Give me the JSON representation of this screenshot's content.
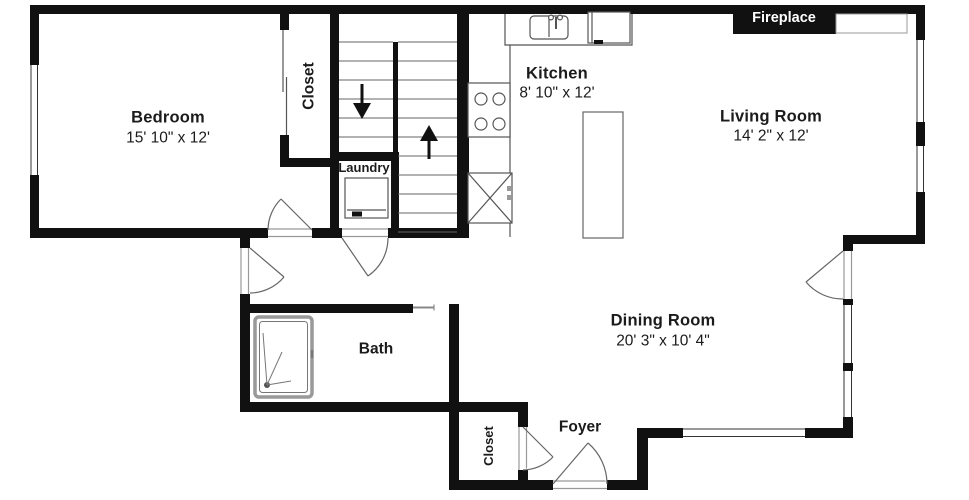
{
  "plan": {
    "title": "First floor apartment floor plan",
    "rooms": {
      "bedroom": {
        "name": "Bedroom",
        "dimensions": "15' 10\" x 12'"
      },
      "kitchen": {
        "name": "Kitchen",
        "dimensions": "8' 10\" x 12'"
      },
      "living_room": {
        "name": "Living Room",
        "dimensions": "14' 2\" x 12'"
      },
      "dining_room": {
        "name": "Dining Room",
        "dimensions": "20' 3\" x 10' 4\""
      },
      "bath": {
        "name": "Bath"
      },
      "laundry": {
        "name": "Laundry"
      },
      "foyer": {
        "name": "Foyer"
      },
      "bedroom_closet": {
        "name": "Closet"
      },
      "foyer_closet": {
        "name": "Closet"
      },
      "fireplace": {
        "name": "Fireplace"
      }
    },
    "fixtures": [
      "kitchen-sink",
      "dishwasher",
      "stove",
      "refrigerator",
      "kitchen-island",
      "washer",
      "shower",
      "stairs-up",
      "stairs-down",
      "fireplace"
    ],
    "colors": {
      "wall": "#111111",
      "background": "#ffffff",
      "fireplace_label_bg": "#111111",
      "fireplace_label_text": "#ffffff",
      "thin_line": "#555555"
    }
  }
}
